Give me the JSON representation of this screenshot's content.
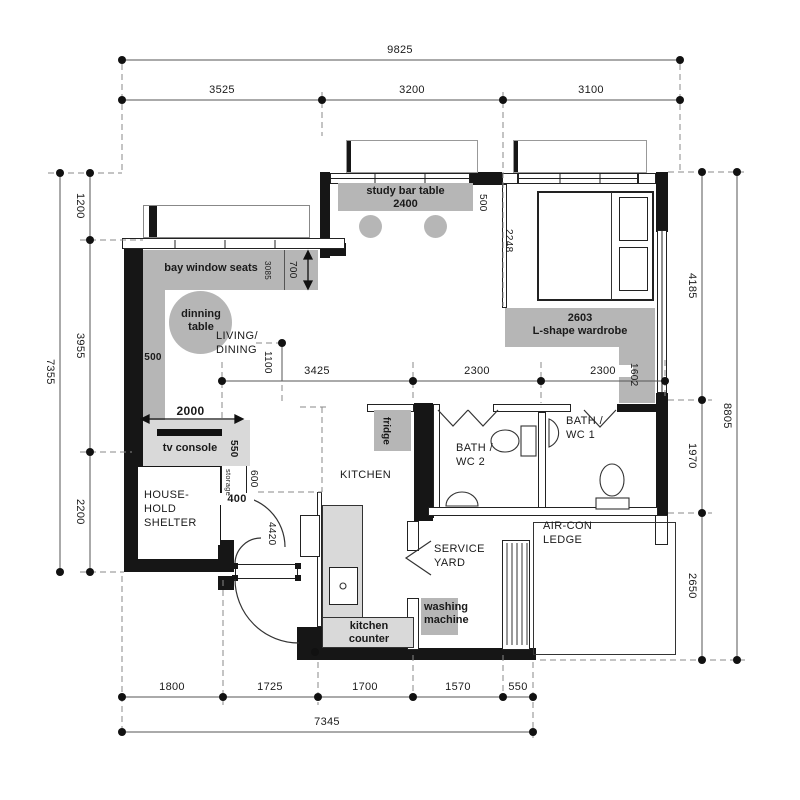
{
  "rooms": {
    "living_dining": "LIVING/\nDINING",
    "kitchen": "KITCHEN",
    "bath_wc2": "BATH /\nWC 2",
    "bath_wc1": "BATH /\nWC 1",
    "service_yard": "SERVICE\nYARD",
    "aircon_ledge": "AIR-CON\nLEDGE",
    "household_shelter": "HOUSE-\nHOLD\nSHELTER"
  },
  "furniture": {
    "study_bar_table": "study bar table\n2400",
    "bay_window_seats": "bay window seats",
    "dining_table": "dinning\ntable",
    "tv_console": "tv console",
    "storage": "storage",
    "fridge": "fridge",
    "kitchen_counter": "kitchen\ncounter",
    "washing_machine": "washing\nmachine",
    "wardrobe": "2603\nL-shape wardrobe"
  },
  "dimensions": {
    "top_total": "9825",
    "top_segments": [
      "3525",
      "3200",
      "3100"
    ],
    "left_total": "7355",
    "left_segments": [
      "1200",
      "3955",
      "2200"
    ],
    "right_total": "8805",
    "right_segments": [
      "4185",
      "1970",
      "2650"
    ],
    "bottom_total": "7345",
    "bottom_segments": [
      "1800",
      "1725",
      "1700",
      "1570",
      "550"
    ],
    "middle_segments": [
      "3425",
      "2300",
      "2300"
    ],
    "hallway_width": "1100",
    "study_table_depth": "500",
    "bay_window_length": "3085",
    "bay_seat_depth": "700",
    "feature_wall_width": "500",
    "tv_console_width": "2000",
    "tv_console_depth": "550",
    "storage_depth": "600",
    "storage_width": "400",
    "foyer_length": "4420",
    "bed_width": "2248",
    "wardrobe_return": "1602"
  },
  "colors": {
    "wall": "#161616",
    "furniture_gray": "#b6b6b6",
    "counter_gray": "#d9d9d9",
    "line": "#444444"
  }
}
